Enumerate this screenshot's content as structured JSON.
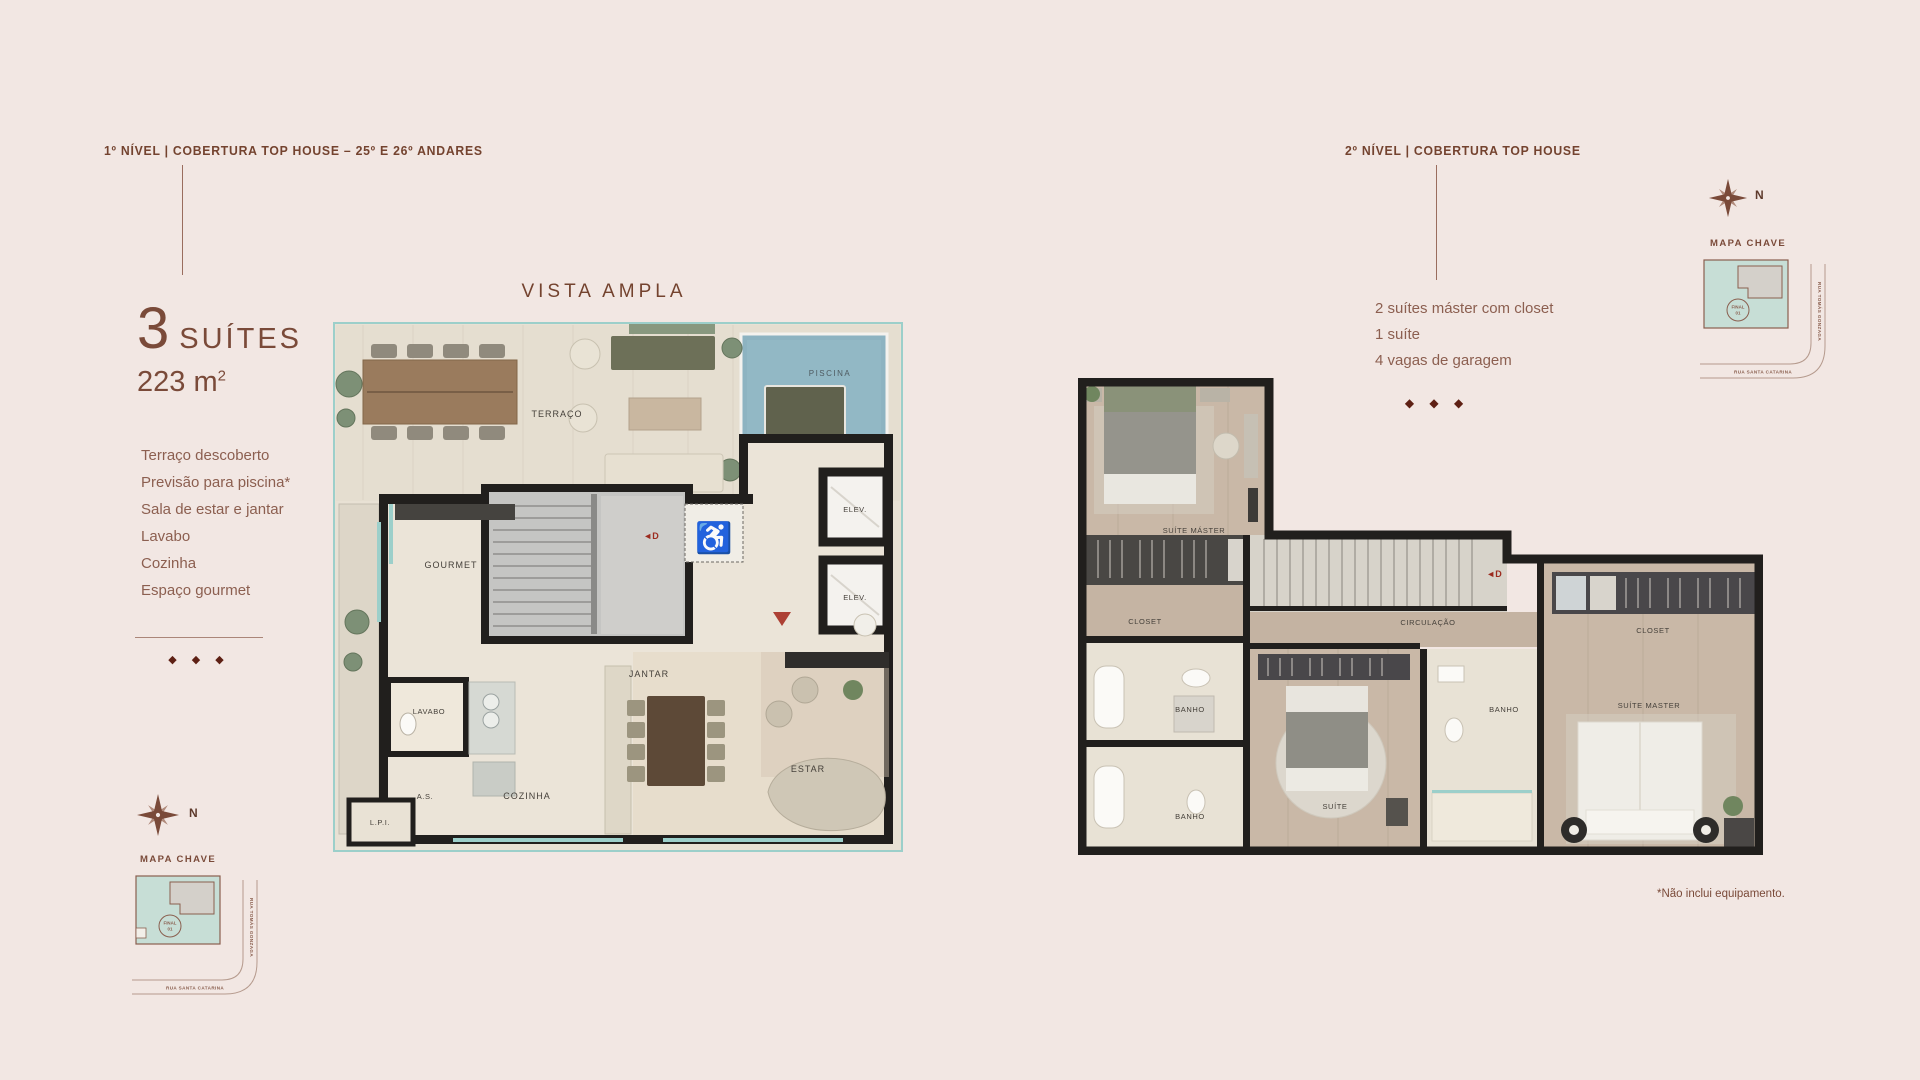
{
  "colors": {
    "background": "#f2e7e3",
    "accent_brown": "#74432f",
    "list_brown": "#8c5f50",
    "diamond": "#5e2014",
    "plan_wall": "#211f1d",
    "window_teal": "#9ccfca",
    "pool_blue": "#8db3c1",
    "map_plot_teal": "#c7ded6"
  },
  "left_panel": {
    "level_title": "1º NÍVEL  |  COBERTURA TOP HOUSE  – 25º E 26º ANDARES",
    "suites_number": "3",
    "suites_word": "SUÍTES",
    "area_text": "223 m",
    "area_exponent": "2",
    "features": [
      "Terraço descoberto",
      "Previsão para piscina*",
      "Sala de estar e jantar",
      "Lavabo",
      "Cozinha",
      "Espaço gourmet"
    ],
    "diamonds": "◆ ◆ ◆"
  },
  "center_plan": {
    "view_title": "VISTA AMPLA",
    "labels": {
      "terraco": "TERRAÇO",
      "piscina": "PISCINA",
      "gourmet": "GOURMET",
      "elev": "ELEV.",
      "jantar": "JANTAR",
      "lavabo": "LAVABO",
      "area_servico": "A.S.",
      "cozinha": "COZINHA",
      "estar": "ESTAR",
      "lpi": "L.P.I.",
      "door_marker": "◄D"
    }
  },
  "right_panel": {
    "level_title": "2º NÍVEL  |  COBERTURA TOP HOUSE",
    "features": [
      "2 suítes máster com closet",
      "1 suíte",
      "4 vagas de garagem"
    ],
    "diamonds": "◆ ◆ ◆"
  },
  "right_plan": {
    "labels": {
      "suite_master": "SUÍTE MÁSTER",
      "closet_left": "CLOSET",
      "banho_1": "BANHO",
      "banho_2": "BANHO",
      "suite": "SUÍTE",
      "circulacao": "CIRCULAÇÃO",
      "banho_3": "BANHO",
      "closet_right": "CLOSET",
      "suite_master_2": "SUÍTE MASTER",
      "door_marker": "◄D"
    }
  },
  "key_map": {
    "title": "MAPA CHAVE",
    "north": "N",
    "street_vertical": "RUA TOMÁS GONZAGA",
    "street_horizontal": "RUA SANTA CATARINA",
    "unit_line1": "FINAL",
    "unit_line2": "01"
  },
  "icons": {
    "wheelchair": "♿"
  },
  "footnote": "*Não inclui equipamento."
}
